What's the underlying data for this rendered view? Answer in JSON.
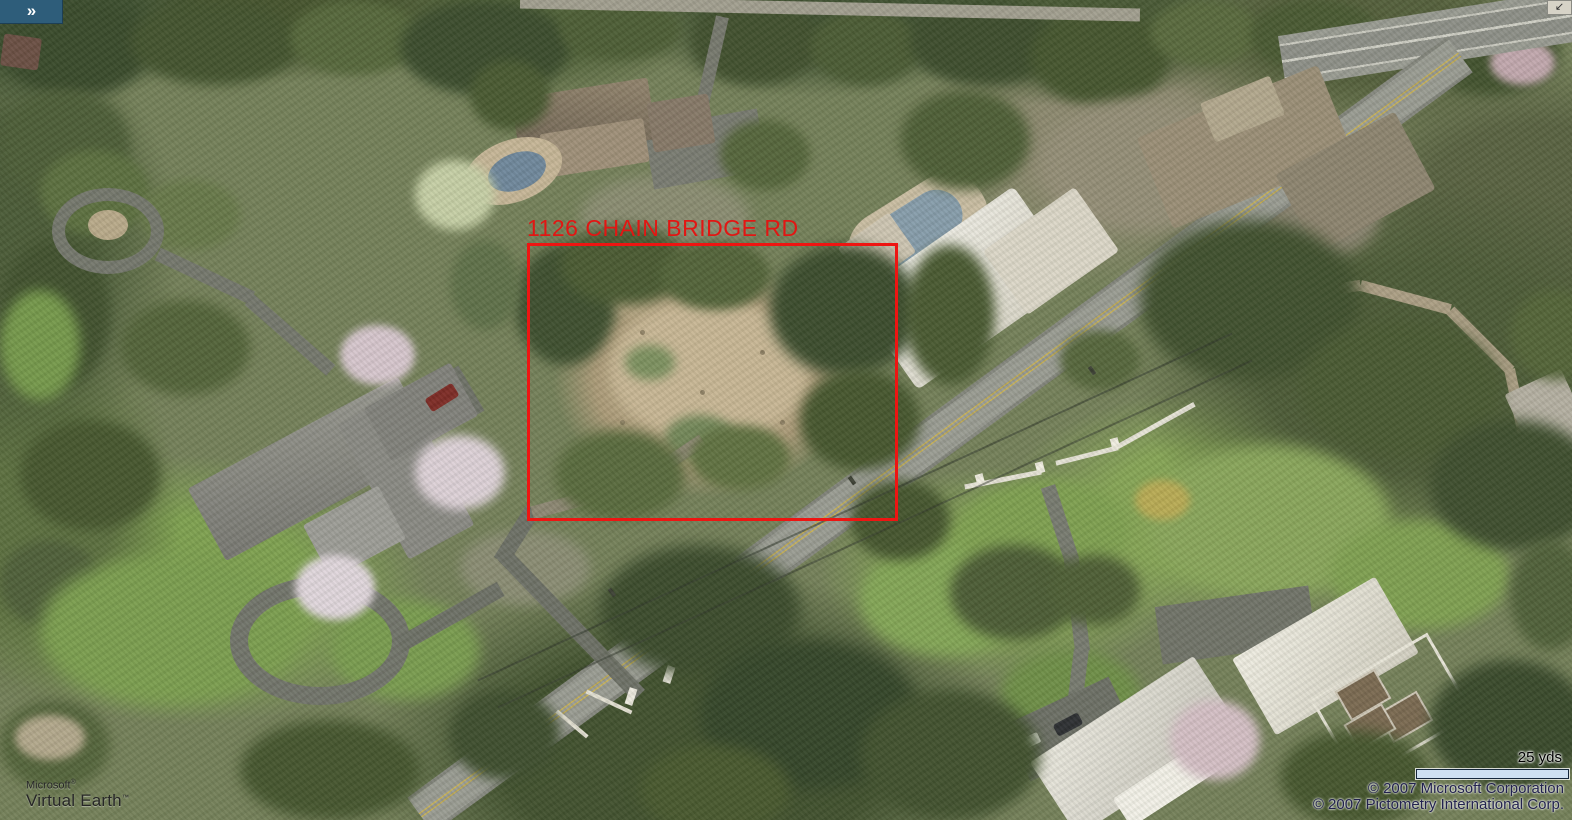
{
  "app": {
    "name": "Microsoft Virtual Earth",
    "view": "oblique-aerial"
  },
  "chrome": {
    "expand_button_glyph": "»",
    "corner_arrow_glyph": "↙"
  },
  "annotation": {
    "address_label": "1126 CHAIN BRIDGE RD",
    "box_color": "#ee1512"
  },
  "branding": {
    "logo_line1": "Microsoft",
    "logo_line1_mark": "®",
    "logo_line2": "Virtual Earth",
    "logo_line2_mark": "™"
  },
  "scale": {
    "label": "25 yds"
  },
  "copyright": {
    "line1": "© 2007 Microsoft Corporation",
    "line2": "© 2007 Pictometry International Corp."
  },
  "colors": {
    "annotation_red": "#e81712",
    "expand_button_bg": "#2e5d7a",
    "scale_bar_fill": "#cfe0f2",
    "scale_bar_border": "#16273c",
    "copyright_text": "#22224e",
    "road_gray": "#9a9c93",
    "road_center_line_yellow": "#c7b054"
  }
}
